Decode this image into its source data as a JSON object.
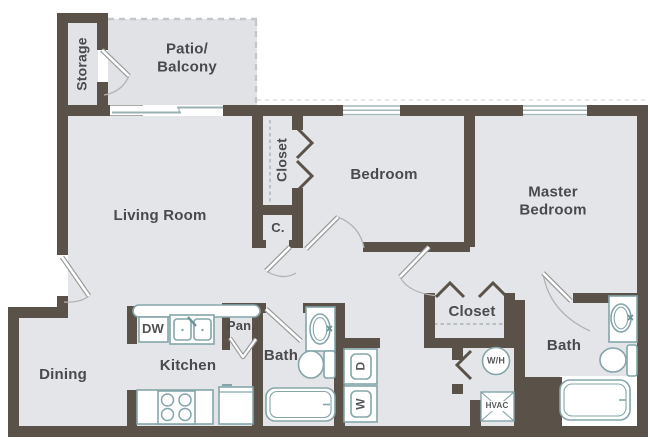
{
  "title": "Two Bedroom Apartment Floor Plan",
  "colors": {
    "wall": "#5a5248",
    "floor": "#e2e4e7",
    "fixture_outline": "#84a6aa",
    "label_text": "#4a4a4c",
    "dashed_line": "#c3c7ca"
  },
  "rooms": {
    "storage": {
      "label": "Storage"
    },
    "patio": {
      "line1": "Patio/",
      "line2": "Balcony"
    },
    "living": {
      "label": "Living Room"
    },
    "bedroom_closet": {
      "label": "Closet"
    },
    "bedroom": {
      "label": "Bedroom"
    },
    "master": {
      "line1": "Master",
      "line2": "Bedroom"
    },
    "small_closet": {
      "label": "C."
    },
    "dining": {
      "label": "Dining"
    },
    "kitchen": {
      "label": "Kitchen"
    },
    "pantry": {
      "label": "Pan."
    },
    "hall_bath": {
      "label": "Bath"
    },
    "master_bath": {
      "label": "Bath"
    },
    "master_closet": {
      "label": "Closet"
    }
  },
  "appliances": {
    "dishwasher": "DW",
    "dryer": "D",
    "washer": "W",
    "water_heater": "W/H",
    "hvac": "HVAC"
  }
}
